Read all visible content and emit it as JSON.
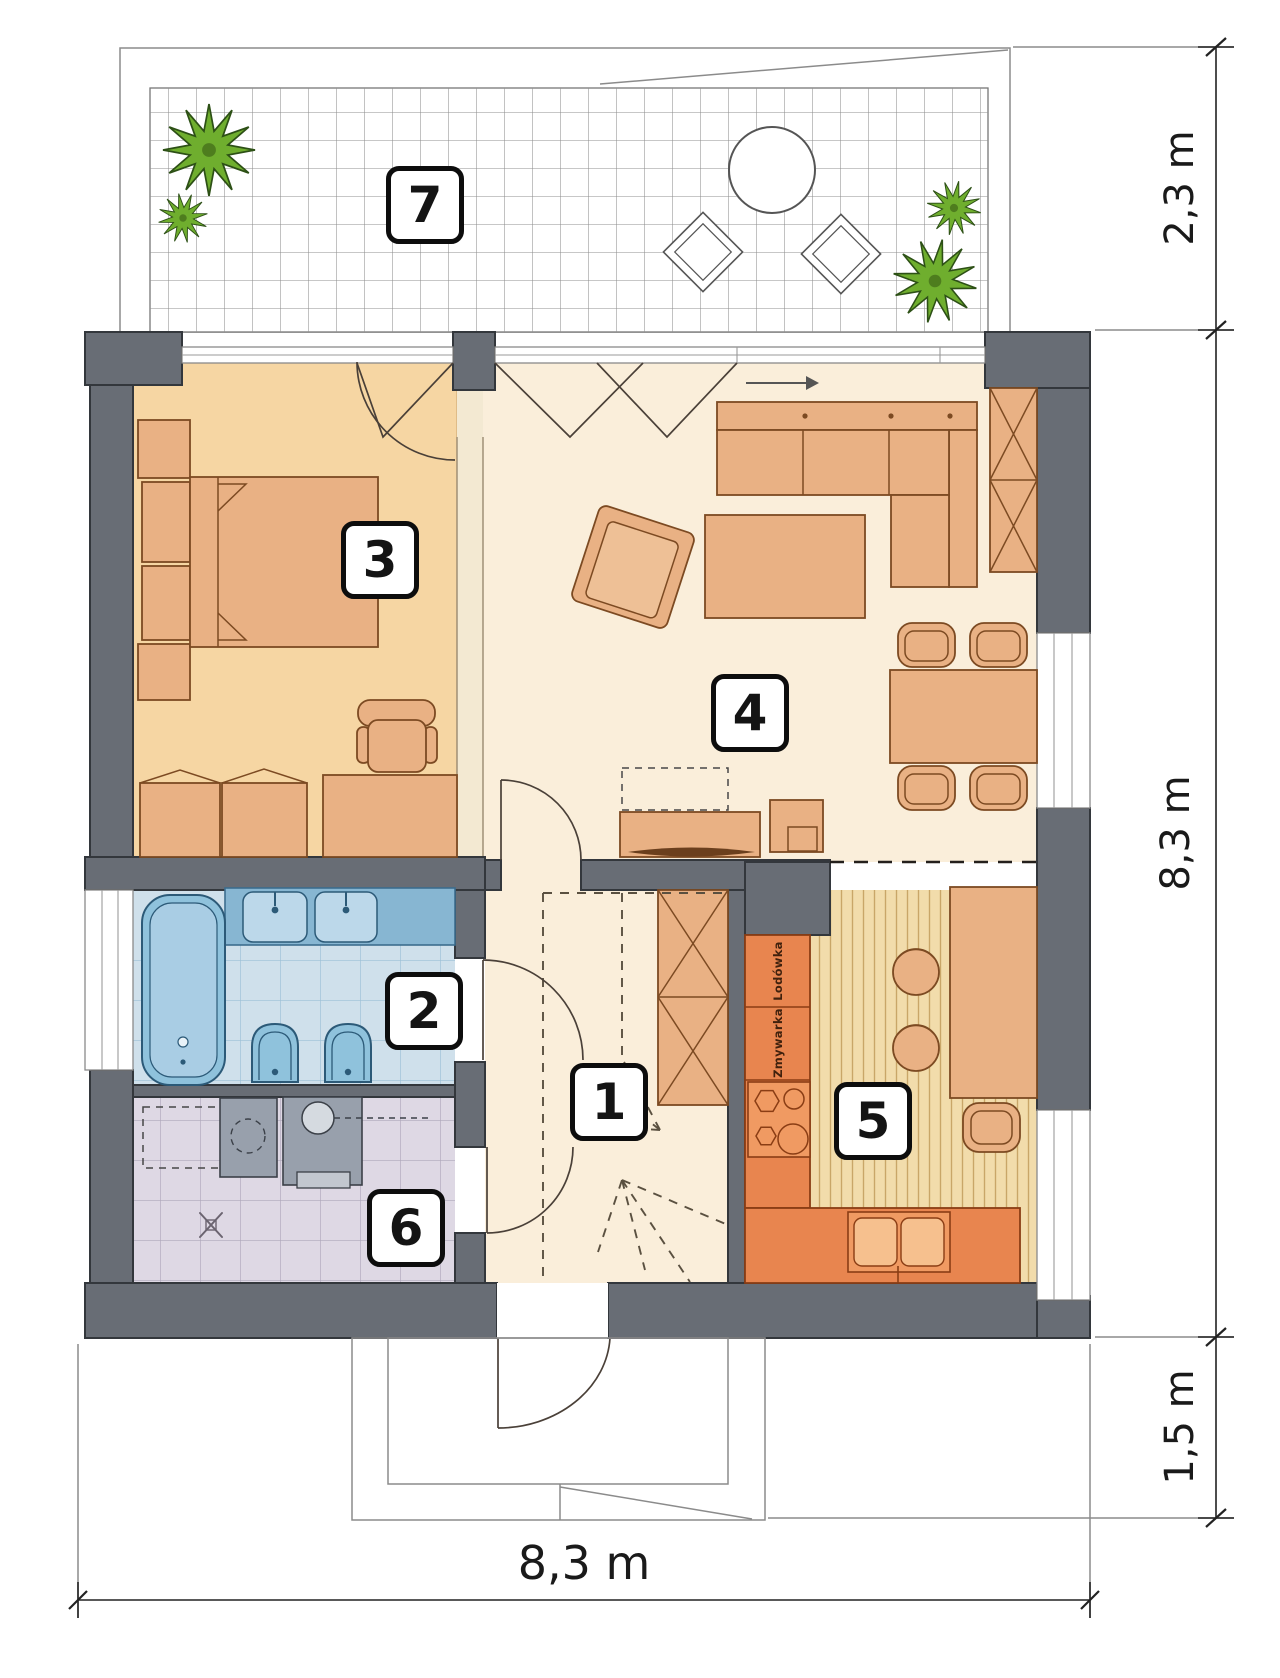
{
  "rooms": [
    {
      "number": "1"
    },
    {
      "number": "2"
    },
    {
      "number": "3"
    },
    {
      "number": "4"
    },
    {
      "number": "5"
    },
    {
      "number": "6"
    },
    {
      "number": "7"
    }
  ],
  "dimensions": {
    "terrace_depth": "2,3 m",
    "house_depth": "8,3 m",
    "porch_depth": "1,5 m",
    "house_width": "8,3 m"
  },
  "appliances": {
    "fridge": "Lodówka",
    "dishwasher": "Zmywarka"
  },
  "colors": {
    "wall": "#686d75",
    "bedroomFloor": "#f6d6a3",
    "livingFloor": "#faeeda",
    "furniture": "#e9b184",
    "kitchenCounter": "#e8854f",
    "kitchenFloor": "#f2dcab",
    "kitchenStripe": "#c9a668",
    "bathCounter": "#87b6d2",
    "bathFixture": "#8fc2dc",
    "bathFloor": "#cfe0eb",
    "utilityFloor": "#ded8e4",
    "appliance": "#98a0ac",
    "plant": "#6fae2e",
    "plantStroke": "#2d5016",
    "terraceLine": "#8f8f8f"
  }
}
